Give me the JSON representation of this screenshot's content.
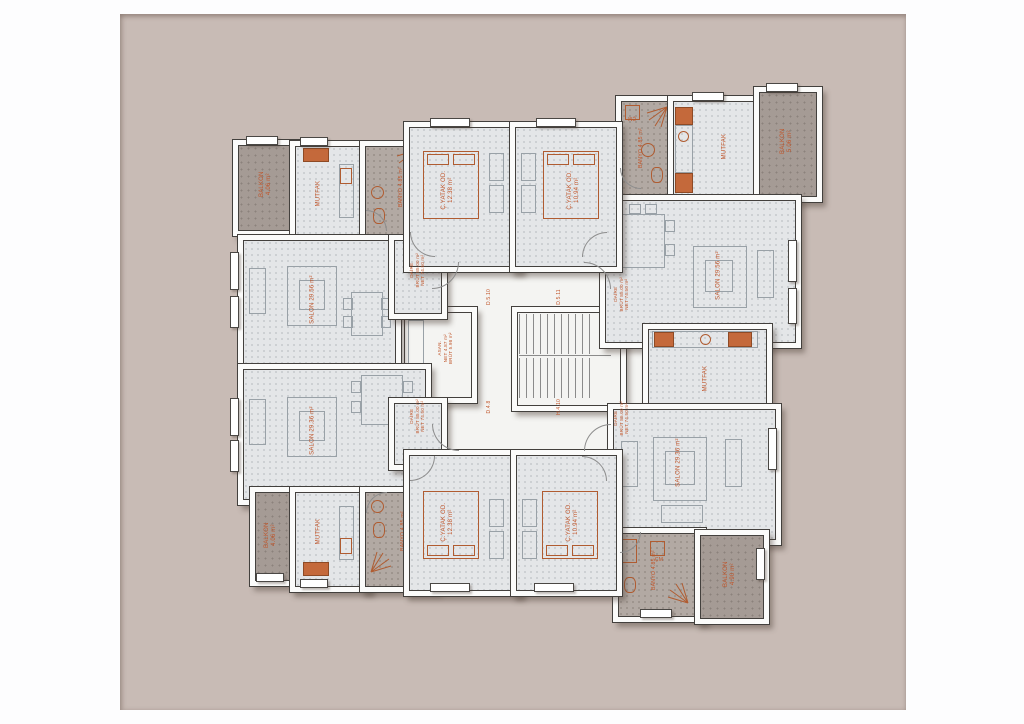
{
  "drawing": {
    "type": "apartment-floor-plan",
    "background_color": "#c8bbb5",
    "floor_color": "#e4e6e8",
    "wet_area_color": "#b2a9a3",
    "balcony_color": "#a59b95",
    "accent_text_color": "#c0552a"
  },
  "labels": {
    "salon_tl": "SALON 29.56 m²",
    "salon_tr": "SALON 29.56 m²",
    "salon_bl": "SALON 29.36 m²",
    "salon_br": "SALON 29.36 m²",
    "kitchen": "MUTFAK",
    "bath": "BANYO 4.85 m²",
    "bedroom_left": "Ç.YATAK OD.\n12.38 m²",
    "bedroom_right": "Ç.YATAK OD.\n10.94 m²",
    "balcony_tl": "BALKON\n4.06 m²",
    "balcony_tr": "BALKON\n5.06 m²",
    "balcony_bl": "BALKON\n4.06 m²",
    "balcony_br": "BALKON\n4.90 m²",
    "wm": "ÇM",
    "elevator": "ASAN.\nNET 4.87 m²\nBRÜT 5.98 m²",
    "entry": "DAİRE\nBRÜT 85.00 m²\nNET 74.50 m²",
    "tags": {
      "a": "D.5.10",
      "b": "D.5.11",
      "c": "D.4.8",
      "d": "H.4.10"
    }
  }
}
